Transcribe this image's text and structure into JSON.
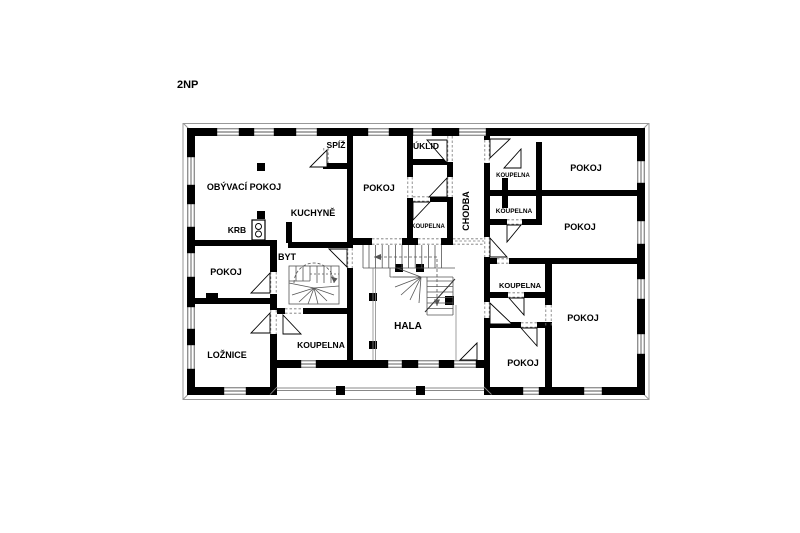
{
  "title": "2NP",
  "colors": {
    "wall": "#000000",
    "detail_line": "#8a8a8a",
    "background": "#ffffff"
  },
  "floor_plan": {
    "floor_label": "2NP",
    "rooms": [
      {
        "id": "obyvaci-pokoj",
        "label": "OBÝVACÍ POKOJ"
      },
      {
        "id": "spiz",
        "label": "SPÍŽ"
      },
      {
        "id": "uklid",
        "label": "ÚKLID"
      },
      {
        "id": "pokoj-stredni",
        "label": "POKOJ"
      },
      {
        "id": "kuchyne",
        "label": "KUCHYNĚ"
      },
      {
        "id": "koupelna-stredni",
        "label": "KOUPELNA"
      },
      {
        "id": "chodba",
        "label": "CHODBA"
      },
      {
        "id": "koupelna-horni-1",
        "label": "KOUPELNA"
      },
      {
        "id": "pokoj-pravy-1",
        "label": "POKOJ"
      },
      {
        "id": "koupelna-horni-2",
        "label": "KOUPELNA"
      },
      {
        "id": "pokoj-pravy-2",
        "label": "POKOJ"
      },
      {
        "id": "krb",
        "label": "KRB"
      },
      {
        "id": "byt",
        "label": "BYT"
      },
      {
        "id": "pokoj-levy",
        "label": "POKOJ"
      },
      {
        "id": "loznice",
        "label": "LOŽNICE"
      },
      {
        "id": "koupelna-byt",
        "label": "KOUPELNA"
      },
      {
        "id": "hala",
        "label": "HALA"
      },
      {
        "id": "koupelna-dolni",
        "label": "KOUPELNA"
      },
      {
        "id": "pokoj-dolni-maly",
        "label": "POKOJ"
      },
      {
        "id": "pokoj-dolni-velky",
        "label": "POKOJ"
      }
    ]
  }
}
